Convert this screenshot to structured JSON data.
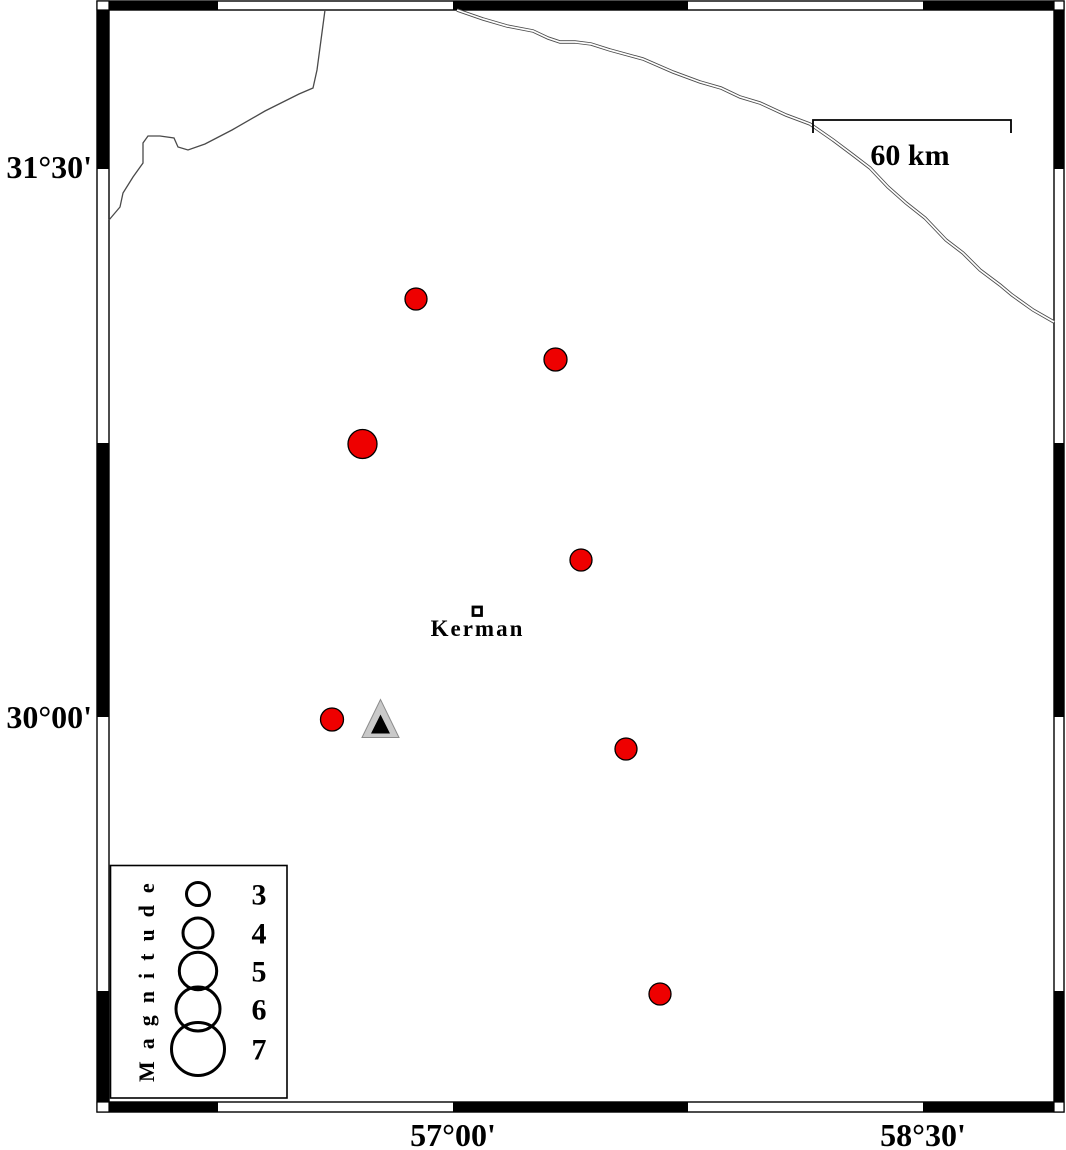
{
  "figure": {
    "type": "seismicity-map",
    "region_note": "map of Kerman area with earthquake epicenters"
  },
  "frame": {
    "left_axis_labels": [
      {
        "text": "31°30'"
      },
      {
        "text": "30°00'"
      }
    ],
    "bottom_axis_labels": [
      {
        "text": "57°00'"
      },
      {
        "text": "58°30'"
      }
    ]
  },
  "scale_bar": {
    "label": "60 km",
    "length_km": 60
  },
  "city": {
    "name": "Kerman"
  },
  "station": {
    "symbol": "triangle"
  },
  "epicenters": [
    {
      "x": 416,
      "y": 299,
      "r": 11,
      "magnitude_est": 2.9
    },
    {
      "x": 555.5,
      "y": 359.5,
      "r": 11.5,
      "magnitude_est": 3.0
    },
    {
      "x": 362.5,
      "y": 444,
      "r": 14.5,
      "magnitude_est": 3.9
    },
    {
      "x": 581,
      "y": 560,
      "r": 11,
      "magnitude_est": 2.9
    },
    {
      "x": 332,
      "y": 719.5,
      "r": 11.5,
      "magnitude_est": 3.0
    },
    {
      "x": 626,
      "y": 749,
      "r": 11,
      "magnitude_est": 2.9
    },
    {
      "x": 660,
      "y": 994,
      "r": 11,
      "magnitude_est": 2.9
    }
  ],
  "legend": {
    "title": "Magnitude",
    "entries": [
      {
        "label": "3",
        "r": 11.5,
        "cy": 894
      },
      {
        "label": "4",
        "r": 15,
        "cy": 933
      },
      {
        "label": "5",
        "r": 18.7,
        "cy": 971
      },
      {
        "label": "6",
        "r": 22,
        "cy": 1009
      },
      {
        "label": "7",
        "r": 26.5,
        "cy": 1049
      }
    ]
  },
  "colors": {
    "epicenter_fill": "#ee0000",
    "epicenter_stroke": "#000000",
    "station_outer": "#c9c9c9",
    "station_outer_edge": "#8c8c8c",
    "station_inner": "#000000",
    "map_line": "#4a4a4a",
    "frame": "#000000"
  }
}
